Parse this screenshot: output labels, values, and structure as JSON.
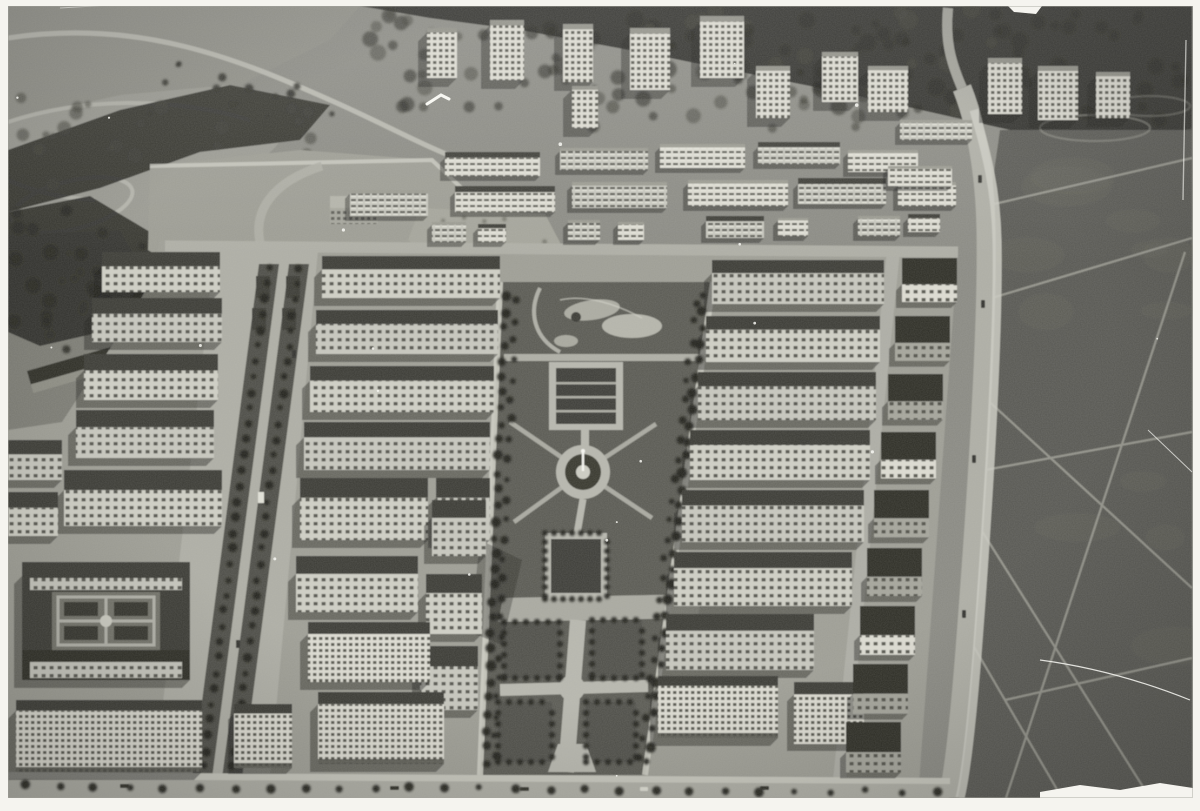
{
  "photo": {
    "kind": "black-and-white oblique aerial photograph",
    "subject": "planned residential district with a long central park, circular fountain plaza, parterre gardens, tree-lined boulevard, rows of apartment blocks, tower blocks at a forest edge, and a large open heath field crossed by footpaths",
    "border": "white paper border around the print"
  },
  "palette": {
    "paper": "#f5f4ef",
    "base": "#8a8a83",
    "meadow": "#8e8e86",
    "meadowLight": "#a0a097",
    "forest": "#2f2f2a",
    "forestDeep": "#20201c",
    "canopy": "#3d3d36",
    "field": "#585852",
    "fieldLight": "#6b6b63",
    "park": "#5a5a53",
    "lawnPanel": "#50504a",
    "path": "#b7b7ae",
    "pathBright": "#cdcdc3",
    "road": "#aeaea5",
    "roof": "#3a3a34",
    "roofDark": "#2d2d28",
    "roofLight": "#8f8f86",
    "facade": "#c7c7be",
    "facadeBright": "#dddcd2",
    "facadeShade": "#a5a59b",
    "window": "#4a4a43",
    "shadow": "#1d1d1a",
    "tree": "#22221e",
    "rubble": "#a4a49a",
    "white": "#f8f8f3"
  },
  "elements": [
    "white-border",
    "northwest-park-meadow",
    "winding-paths",
    "forest-ridge",
    "tower-blocks",
    "lamella-apartment-rows",
    "construction-site",
    "playfield",
    "central-park",
    "pond",
    "parterre-garden-upper",
    "fountain-circle",
    "parterre-garden-square",
    "lawn-panels",
    "tree-lined-boulevard",
    "median-gardens",
    "apartment-slab-blocks",
    "perimeter-block-courtyard",
    "edge-road",
    "heath-field",
    "field-footpaths",
    "bottom-street",
    "street-trees",
    "cars",
    "film-grain",
    "scratches",
    "dust-specks"
  ]
}
